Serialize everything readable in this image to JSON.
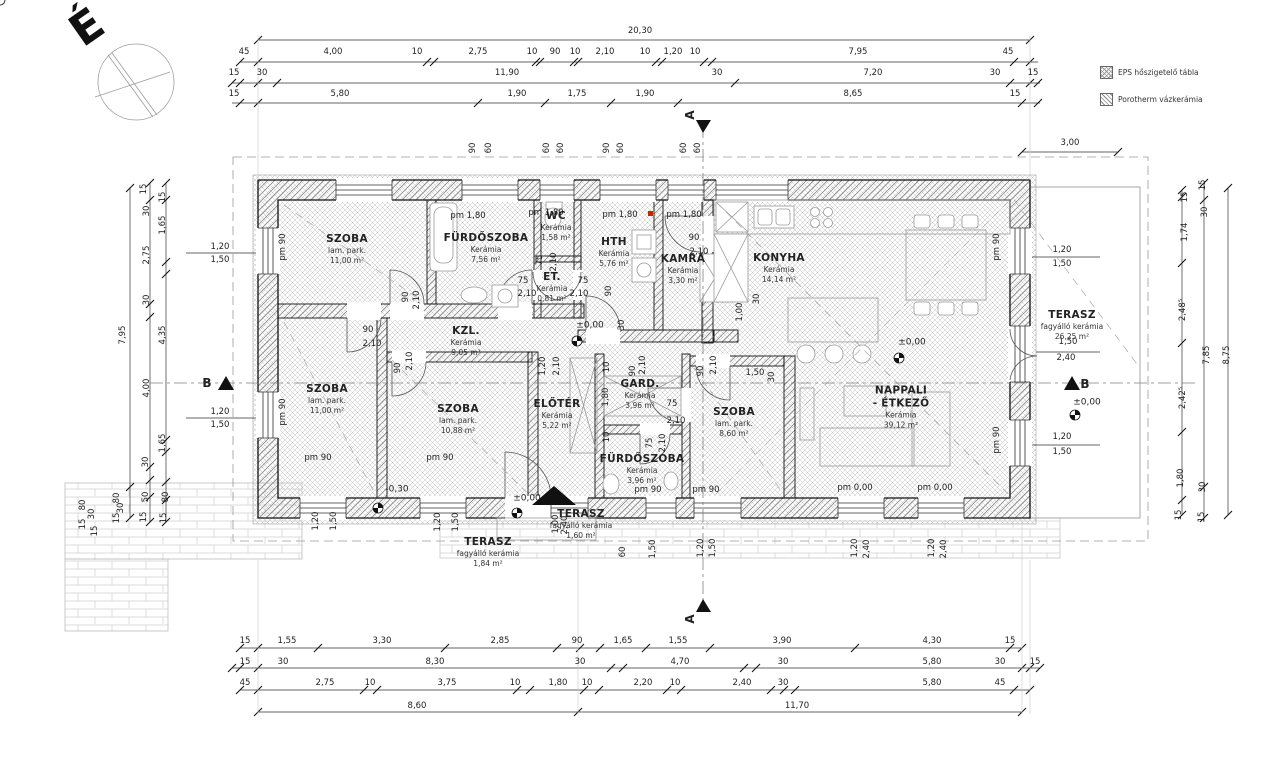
{
  "north_letter": "É",
  "legend": {
    "items": [
      {
        "icon": "eps-swatch",
        "label": "EPS  hőszigetelő tábla"
      },
      {
        "icon": "porotherm-swatch",
        "label": "Porotherm vázkerámia"
      }
    ]
  },
  "rooms": [
    {
      "name": "SZOBA",
      "finish": "lam. park.",
      "area": "11,00 m²",
      "x": 347,
      "y": 249
    },
    {
      "name": "FÜRDŐSZOBA",
      "finish": "Kerámia",
      "area": "7,56 m²",
      "x": 486,
      "y": 248
    },
    {
      "name": "WC",
      "finish": "Kerámia",
      "area": "1,58 m²",
      "x": 556,
      "y": 226
    },
    {
      "name": "HTH",
      "finish": "Kerámia",
      "area": "5,76 m²",
      "x": 614,
      "y": 252
    },
    {
      "name": "KAMRA",
      "finish": "Kerámia",
      "area": "3,30 m²",
      "x": 683,
      "y": 269
    },
    {
      "name": "KONYHA",
      "finish": "Kerámia",
      "area": "14,14 m²",
      "x": 779,
      "y": 268
    },
    {
      "name": "KZL.",
      "finish": "Kerámia",
      "area": "9,05 m²",
      "x": 466,
      "y": 341
    },
    {
      "name": "ET.",
      "finish": "Kerámia",
      "area": "0,81 m²",
      "x": 552,
      "y": 287
    },
    {
      "name": "SZOBA",
      "finish": "lam. park.",
      "area": "11,00 m²",
      "x": 327,
      "y": 399
    },
    {
      "name": "SZOBA",
      "finish": "lam. park.",
      "area": "10,88 m²",
      "x": 458,
      "y": 419
    },
    {
      "name": "ELŐTÉR",
      "finish": "Kerámia",
      "area": "5,22 m²",
      "x": 557,
      "y": 414
    },
    {
      "name": "GARD.",
      "finish": "Kerámia",
      "area": "3,96 m²",
      "x": 640,
      "y": 394
    },
    {
      "name": "FÜRDŐSZOBA",
      "finish": "Kerámia",
      "area": "3,96 m²",
      "x": 642,
      "y": 469
    },
    {
      "name": "SZOBA",
      "finish": "lam. park.",
      "area": "8,60 m²",
      "x": 734,
      "y": 422
    },
    {
      "name": "NAPPALI",
      "name2": "- ÉTKEZŐ",
      "finish": "Kerámia",
      "area": "39,12 m²",
      "x": 901,
      "y": 407
    },
    {
      "name": "TERASZ",
      "finish": "fagyálló kerámia",
      "area": "26,25 m²",
      "x": 1072,
      "y": 325
    },
    {
      "name": "TERASZ",
      "finish": "fagyálló kerámia",
      "area": "1,60 m²",
      "x": 581,
      "y": 524
    },
    {
      "name": "TERASZ",
      "finish": "fagyálló kerámia",
      "area": "1,84 m²",
      "x": 488,
      "y": 552
    }
  ],
  "labels": [
    {
      "t": "20,30",
      "x": 640,
      "y": 31
    },
    {
      "t": "45",
      "x": 244,
      "y": 52
    },
    {
      "t": "4,00",
      "x": 333,
      "y": 52
    },
    {
      "t": "10",
      "x": 417,
      "y": 52
    },
    {
      "t": "2,75",
      "x": 478,
      "y": 52
    },
    {
      "t": "10",
      "x": 532,
      "y": 52
    },
    {
      "t": "90",
      "x": 555,
      "y": 52
    },
    {
      "t": "10",
      "x": 575,
      "y": 52
    },
    {
      "t": "2,10",
      "x": 605,
      "y": 52
    },
    {
      "t": "10",
      "x": 645,
      "y": 52
    },
    {
      "t": "1,20",
      "x": 673,
      "y": 52
    },
    {
      "t": "10",
      "x": 695,
      "y": 52
    },
    {
      "t": "7,95",
      "x": 858,
      "y": 52
    },
    {
      "t": "45",
      "x": 1008,
      "y": 52
    },
    {
      "t": "15",
      "x": 234,
      "y": 73
    },
    {
      "t": "30",
      "x": 262,
      "y": 73
    },
    {
      "t": "11,90",
      "x": 507,
      "y": 73
    },
    {
      "t": "30",
      "x": 717,
      "y": 73
    },
    {
      "t": "7,20",
      "x": 873,
      "y": 73
    },
    {
      "t": "30",
      "x": 995,
      "y": 73
    },
    {
      "t": "15",
      "x": 1033,
      "y": 73
    },
    {
      "t": "15",
      "x": 234,
      "y": 94
    },
    {
      "t": "5,80",
      "x": 340,
      "y": 94
    },
    {
      "t": "1,90",
      "x": 517,
      "y": 94
    },
    {
      "t": "1,75",
      "x": 577,
      "y": 94
    },
    {
      "t": "1,90",
      "x": 645,
      "y": 94
    },
    {
      "t": "8,65",
      "x": 853,
      "y": 94
    },
    {
      "t": "15",
      "x": 1015,
      "y": 94
    },
    {
      "t": "3,00",
      "x": 1070,
      "y": 143
    },
    {
      "t": "90",
      "x": 473,
      "y": 148,
      "r": 1
    },
    {
      "t": "60",
      "x": 489,
      "y": 148,
      "r": 1
    },
    {
      "t": "60",
      "x": 547,
      "y": 148,
      "r": 1
    },
    {
      "t": "60",
      "x": 561,
      "y": 148,
      "r": 1
    },
    {
      "t": "90",
      "x": 607,
      "y": 148,
      "r": 1
    },
    {
      "t": "60",
      "x": 621,
      "y": 148,
      "r": 1
    },
    {
      "t": "60",
      "x": 684,
      "y": 148,
      "r": 1
    },
    {
      "t": "60",
      "x": 698,
      "y": 148,
      "r": 1
    },
    {
      "t": "15",
      "x": 245,
      "y": 641
    },
    {
      "t": "1,55",
      "x": 287,
      "y": 641
    },
    {
      "t": "3,30",
      "x": 382,
      "y": 641
    },
    {
      "t": "2,85",
      "x": 500,
      "y": 641
    },
    {
      "t": "90",
      "x": 577,
      "y": 641
    },
    {
      "t": "1,65",
      "x": 623,
      "y": 641
    },
    {
      "t": "1,55",
      "x": 678,
      "y": 641
    },
    {
      "t": "3,90",
      "x": 782,
      "y": 641
    },
    {
      "t": "4,30",
      "x": 932,
      "y": 641
    },
    {
      "t": "15",
      "x": 1010,
      "y": 641
    },
    {
      "t": "15",
      "x": 245,
      "y": 662
    },
    {
      "t": "30",
      "x": 283,
      "y": 662
    },
    {
      "t": "8,30",
      "x": 435,
      "y": 662
    },
    {
      "t": "30",
      "x": 580,
      "y": 662
    },
    {
      "t": "4,70",
      "x": 680,
      "y": 662
    },
    {
      "t": "30",
      "x": 783,
      "y": 662
    },
    {
      "t": "5,80",
      "x": 932,
      "y": 662
    },
    {
      "t": "30",
      "x": 1000,
      "y": 662
    },
    {
      "t": "15",
      "x": 1035,
      "y": 662
    },
    {
      "t": "45",
      "x": 245,
      "y": 683
    },
    {
      "t": "2,75",
      "x": 325,
      "y": 683
    },
    {
      "t": "10",
      "x": 370,
      "y": 683
    },
    {
      "t": "3,75",
      "x": 447,
      "y": 683
    },
    {
      "t": "10",
      "x": 515,
      "y": 683
    },
    {
      "t": "1,80",
      "x": 558,
      "y": 683
    },
    {
      "t": "10",
      "x": 587,
      "y": 683
    },
    {
      "t": "2,20",
      "x": 643,
      "y": 683
    },
    {
      "t": "10",
      "x": 675,
      "y": 683
    },
    {
      "t": "2,40",
      "x": 742,
      "y": 683
    },
    {
      "t": "30",
      "x": 783,
      "y": 683
    },
    {
      "t": "5,80",
      "x": 932,
      "y": 683
    },
    {
      "t": "45",
      "x": 1000,
      "y": 683
    },
    {
      "t": "8,60",
      "x": 417,
      "y": 706
    },
    {
      "t": "11,70",
      "x": 797,
      "y": 706
    },
    {
      "t": "7,95",
      "x": 123,
      "y": 335,
      "r": 1
    },
    {
      "t": "80",
      "x": 117,
      "y": 498,
      "r": 1
    },
    {
      "t": "30",
      "x": 121,
      "y": 508,
      "r": 1
    },
    {
      "t": "15",
      "x": 117,
      "y": 518,
      "r": 1
    },
    {
      "t": "15",
      "x": 144,
      "y": 189,
      "r": 1
    },
    {
      "t": "30",
      "x": 147,
      "y": 211,
      "r": 1
    },
    {
      "t": "2,75",
      "x": 147,
      "y": 255,
      "r": 1
    },
    {
      "t": "30",
      "x": 147,
      "y": 300,
      "r": 1
    },
    {
      "t": "4,00",
      "x": 147,
      "y": 388,
      "r": 1
    },
    {
      "t": "30",
      "x": 146,
      "y": 462,
      "r": 1
    },
    {
      "t": "50",
      "x": 146,
      "y": 497,
      "r": 1
    },
    {
      "t": "15",
      "x": 144,
      "y": 517,
      "r": 1
    },
    {
      "t": "15",
      "x": 163,
      "y": 197,
      "r": 1
    },
    {
      "t": "1,65",
      "x": 163,
      "y": 225,
      "r": 1
    },
    {
      "t": "4,35",
      "x": 163,
      "y": 335,
      "r": 1
    },
    {
      "t": "1,65",
      "x": 163,
      "y": 443,
      "r": 1
    },
    {
      "t": "80",
      "x": 166,
      "y": 497,
      "r": 1
    },
    {
      "t": "15",
      "x": 164,
      "y": 518,
      "r": 1
    },
    {
      "t": "80",
      "x": 83,
      "y": 505,
      "r": 1
    },
    {
      "t": "30",
      "x": 92,
      "y": 514,
      "r": 1
    },
    {
      "t": "15",
      "x": 83,
      "y": 524,
      "r": 1
    },
    {
      "t": "15",
      "x": 95,
      "y": 531,
      "r": 1
    },
    {
      "t": "1,20",
      "x": 220,
      "y": 247
    },
    {
      "t": "1,50",
      "x": 220,
      "y": 260
    },
    {
      "t": "1,20",
      "x": 220,
      "y": 412
    },
    {
      "t": "1,50",
      "x": 220,
      "y": 425
    },
    {
      "t": "15",
      "x": 1185,
      "y": 197,
      "r": 1
    },
    {
      "t": "1,74",
      "x": 1185,
      "y": 232,
      "r": 1
    },
    {
      "t": "2,48⁵",
      "x": 1183,
      "y": 310,
      "r": 1
    },
    {
      "t": "2,42⁵",
      "x": 1183,
      "y": 398,
      "r": 1
    },
    {
      "t": "1,80",
      "x": 1181,
      "y": 478,
      "r": 1
    },
    {
      "t": "15",
      "x": 1179,
      "y": 515,
      "r": 1
    },
    {
      "t": "15",
      "x": 1203,
      "y": 185,
      "r": 1
    },
    {
      "t": "30",
      "x": 1205,
      "y": 212,
      "r": 1
    },
    {
      "t": "7,85",
      "x": 1207,
      "y": 355,
      "r": 1
    },
    {
      "t": "30",
      "x": 1203,
      "y": 487,
      "r": 1
    },
    {
      "t": "15",
      "x": 1202,
      "y": 517,
      "r": 1
    },
    {
      "t": "8,75",
      "x": 1227,
      "y": 355,
      "r": 1
    },
    {
      "t": "1,20",
      "x": 1062,
      "y": 250
    },
    {
      "t": "1,50",
      "x": 1062,
      "y": 264
    },
    {
      "t": "1,50",
      "x": 1068,
      "y": 342
    },
    {
      "t": "2,40",
      "x": 1066,
      "y": 358
    },
    {
      "t": "1,20",
      "x": 1062,
      "y": 437
    },
    {
      "t": "1,50",
      "x": 1062,
      "y": 452
    },
    {
      "t": "pm 1,80",
      "x": 468,
      "y": 216,
      "c": "pm"
    },
    {
      "t": "pm 1,80",
      "x": 546,
      "y": 213,
      "c": "pm"
    },
    {
      "t": "pm 1,80",
      "x": 620,
      "y": 215,
      "c": "pm"
    },
    {
      "t": "pm 1,80",
      "x": 684,
      "y": 215,
      "c": "pm"
    },
    {
      "t": "pm 90",
      "x": 283,
      "y": 247,
      "r": 1,
      "c": "pm"
    },
    {
      "t": "pm 90",
      "x": 283,
      "y": 412,
      "r": 1,
      "c": "pm"
    },
    {
      "t": "pm 90",
      "x": 997,
      "y": 247,
      "r": 1,
      "c": "pm"
    },
    {
      "t": "pm 90",
      "x": 997,
      "y": 440,
      "r": 1,
      "c": "pm"
    },
    {
      "t": "pm 90",
      "x": 318,
      "y": 458,
      "c": "pm"
    },
    {
      "t": "pm 90",
      "x": 440,
      "y": 458,
      "c": "pm"
    },
    {
      "t": "pm 90",
      "x": 648,
      "y": 490,
      "c": "pm"
    },
    {
      "t": "pm 90",
      "x": 706,
      "y": 490,
      "c": "pm"
    },
    {
      "t": "pm 0,00",
      "x": 855,
      "y": 488,
      "c": "pm"
    },
    {
      "t": "pm 0,00",
      "x": 935,
      "y": 488,
      "c": "pm"
    },
    {
      "t": "90",
      "x": 368,
      "y": 330
    },
    {
      "t": "2,10",
      "x": 372,
      "y": 344
    },
    {
      "t": "90",
      "x": 398,
      "y": 368,
      "r": 1
    },
    {
      "t": "2,10",
      "x": 410,
      "y": 361,
      "r": 1
    },
    {
      "t": "90",
      "x": 406,
      "y": 297,
      "r": 1
    },
    {
      "t": "2,10",
      "x": 417,
      "y": 300,
      "r": 1
    },
    {
      "t": "75",
      "x": 540,
      "y": 260,
      "r": 1
    },
    {
      "t": "2,10",
      "x": 554,
      "y": 262,
      "r": 1
    },
    {
      "t": "75",
      "x": 523,
      "y": 281
    },
    {
      "t": "2,10",
      "x": 527,
      "y": 294
    },
    {
      "t": "75",
      "x": 583,
      "y": 281
    },
    {
      "t": "2,10",
      "x": 579,
      "y": 294
    },
    {
      "t": "90",
      "x": 694,
      "y": 238
    },
    {
      "t": "2,10",
      "x": 699,
      "y": 252
    },
    {
      "t": "90",
      "x": 609,
      "y": 291,
      "r": 1
    },
    {
      "t": "30",
      "x": 622,
      "y": 325,
      "r": 1
    },
    {
      "t": "1,00",
      "x": 740,
      "y": 312,
      "r": 1
    },
    {
      "t": "30",
      "x": 757,
      "y": 299,
      "r": 1
    },
    {
      "t": "90",
      "x": 633,
      "y": 371,
      "r": 1
    },
    {
      "t": "2,10",
      "x": 643,
      "y": 365,
      "r": 1
    },
    {
      "t": "90",
      "x": 701,
      "y": 371,
      "r": 1
    },
    {
      "t": "2,10",
      "x": 714,
      "y": 365,
      "r": 1
    },
    {
      "t": "1,50",
      "x": 755,
      "y": 373
    },
    {
      "t": "30",
      "x": 772,
      "y": 377,
      "r": 1
    },
    {
      "t": "75",
      "x": 672,
      "y": 404
    },
    {
      "t": "2,10",
      "x": 676,
      "y": 421
    },
    {
      "t": "75",
      "x": 650,
      "y": 443,
      "r": 1
    },
    {
      "t": "2,10",
      "x": 663,
      "y": 443,
      "r": 1
    },
    {
      "t": "10",
      "x": 607,
      "y": 367,
      "r": 1
    },
    {
      "t": "1,80",
      "x": 606,
      "y": 397,
      "r": 1
    },
    {
      "t": "10",
      "x": 607,
      "y": 437,
      "r": 1
    },
    {
      "t": "1,20",
      "x": 543,
      "y": 366,
      "r": 1
    },
    {
      "t": "2,10",
      "x": 557,
      "y": 366,
      "r": 1
    },
    {
      "t": "60",
      "x": 623,
      "y": 552,
      "r": 1
    },
    {
      "t": "1,50",
      "x": 653,
      "y": 549,
      "r": 1
    },
    {
      "t": "1,20",
      "x": 701,
      "y": 548,
      "r": 1
    },
    {
      "t": "1,50",
      "x": 713,
      "y": 548,
      "r": 1
    },
    {
      "t": "1,20",
      "x": 855,
      "y": 548,
      "r": 1
    },
    {
      "t": "2,40",
      "x": 867,
      "y": 549,
      "r": 1
    },
    {
      "t": "1,20",
      "x": 932,
      "y": 548,
      "r": 1
    },
    {
      "t": "2,40",
      "x": 944,
      "y": 549,
      "r": 1
    },
    {
      "t": "1,20",
      "x": 438,
      "y": 522,
      "r": 1
    },
    {
      "t": "1,50",
      "x": 456,
      "y": 522,
      "r": 1
    },
    {
      "t": "1,00",
      "x": 556,
      "y": 524,
      "r": 1
    },
    {
      "t": "2,40",
      "x": 565,
      "y": 525,
      "r": 1
    },
    {
      "t": "1,20",
      "x": 316,
      "y": 521,
      "r": 1
    },
    {
      "t": "1,50",
      "x": 334,
      "y": 521,
      "r": 1
    },
    {
      "t": "±0,00",
      "x": 590,
      "y": 326,
      "c": "lvl"
    },
    {
      "t": "±0,00",
      "x": 912,
      "y": 343,
      "c": "lvl"
    },
    {
      "t": "±0,00",
      "x": 527,
      "y": 499,
      "c": "lvl"
    },
    {
      "t": "±0,00",
      "x": 1087,
      "y": 403,
      "c": "lvl"
    },
    {
      "t": "-0,30",
      "x": 397,
      "y": 490,
      "c": "lvl"
    },
    {
      "t": "B",
      "x": 207,
      "y": 383,
      "c": "sec"
    },
    {
      "t": "B",
      "x": 1085,
      "y": 384,
      "c": "sec"
    },
    {
      "t": "A",
      "x": 690,
      "y": 115,
      "r": 1,
      "c": "sec"
    },
    {
      "t": "A",
      "x": 690,
      "y": 619,
      "r": 1,
      "c": "sec"
    }
  ]
}
